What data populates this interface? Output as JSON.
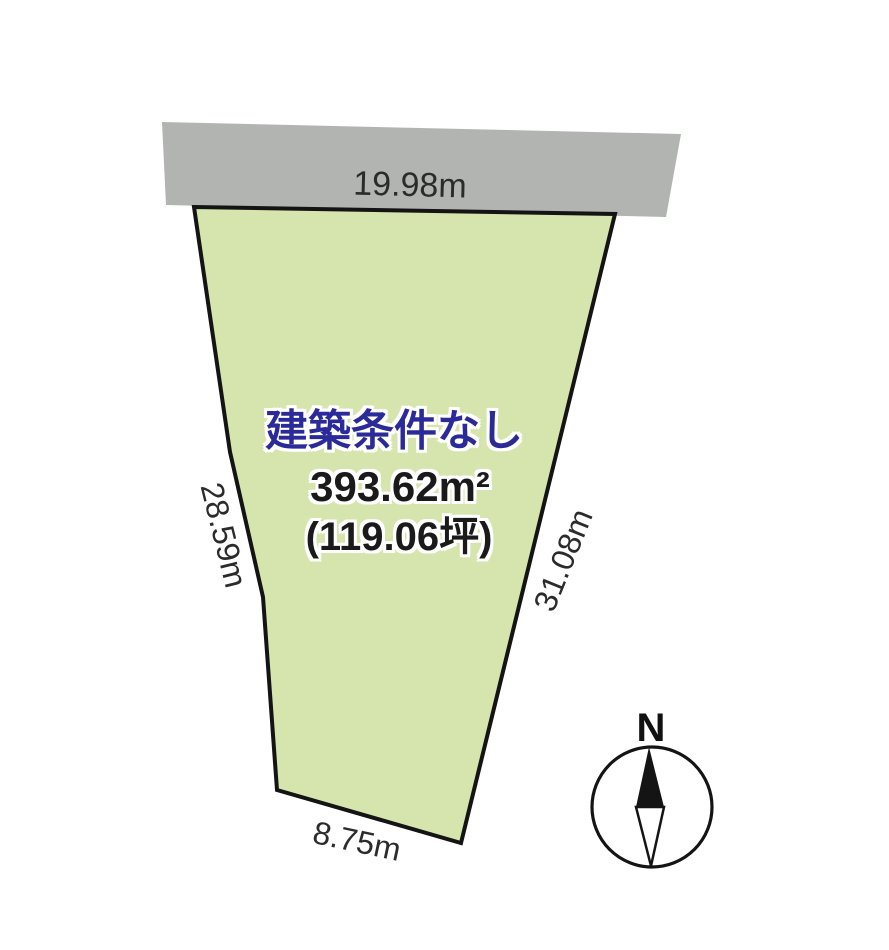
{
  "diagram_title": "land-plot-diagram",
  "colors": {
    "plot_fill": "#d6e4ae",
    "road_fill": "#b2b4b2",
    "outline": "#141414",
    "condition_text": "#2a2a99",
    "dimension_text": "#2b2b2b",
    "compass_fill": "#ffffff"
  },
  "plot": {
    "condition": "建築条件なし",
    "area_sqm": "393.62m²",
    "area_tsubo": "(119.06坪)",
    "dim_top": "19.98m",
    "dim_left": "28.59m",
    "dim_right": "31.08m",
    "dim_bottom": "8.75m"
  },
  "compass": {
    "north": "N"
  }
}
